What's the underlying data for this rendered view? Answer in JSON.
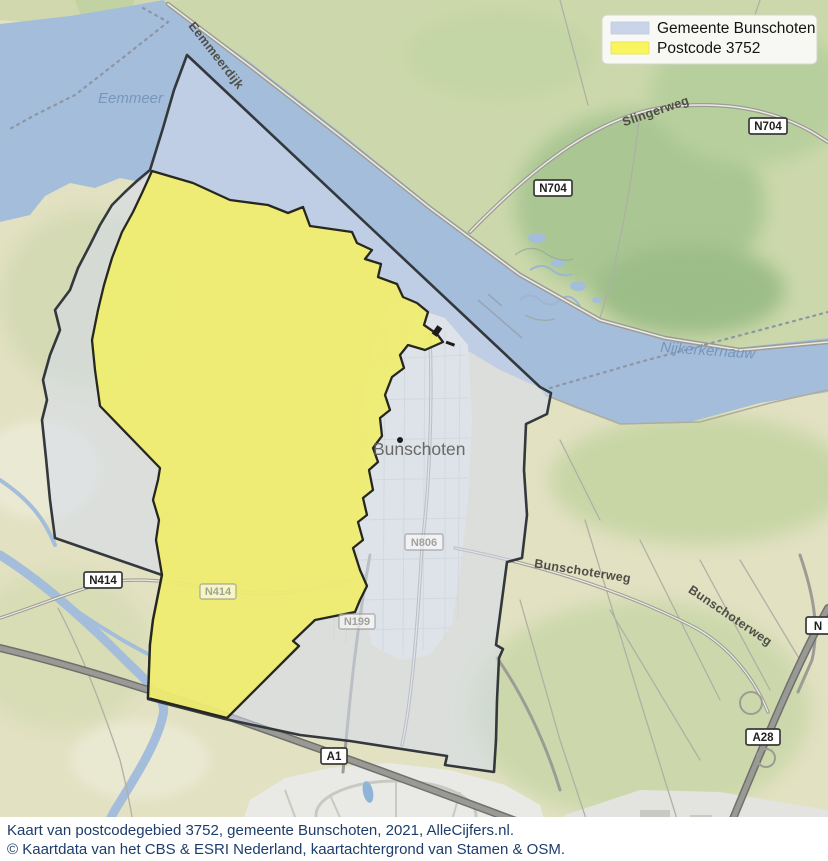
{
  "legend": {
    "items": [
      {
        "label": "Gemeente Bunschoten",
        "swatch": "#c9d4e8"
      },
      {
        "label": "Postcode 3752",
        "swatch": "#f8f55f"
      }
    ]
  },
  "caption": {
    "line1": "Kaart van postcodegebied 3752, gemeente Bunschoten, 2021, AlleCijfers.nl.",
    "line2": "© Kaartdata van het CBS & ESRI Nederland, kaartachtergrond van Stamen & OSM."
  },
  "map": {
    "city": "Bunschoten",
    "water_labels": {
      "eemmeer": "Eemmeer",
      "nijkerkernauw": "Nijkerkernauw"
    },
    "road_labels": {
      "eemmeerdijk": "Eemmeerdijk",
      "slingerweg": "Slingerweg",
      "bunschoterweg_a": "Bunschoterweg",
      "bunschoterweg_b": "Bunschoterweg"
    },
    "shields": {
      "n704_a": "N704",
      "n704_b": "N704",
      "n414_a": "N414",
      "n414_b": "N414",
      "n199": "N199",
      "n806": "N806",
      "a1": "A1",
      "a28": "A28",
      "edge_partial": "N"
    },
    "colors": {
      "water": "#a4bdda",
      "municipality_fill": "#d5dcee",
      "postcode_fill": "#f0ee66"
    }
  }
}
